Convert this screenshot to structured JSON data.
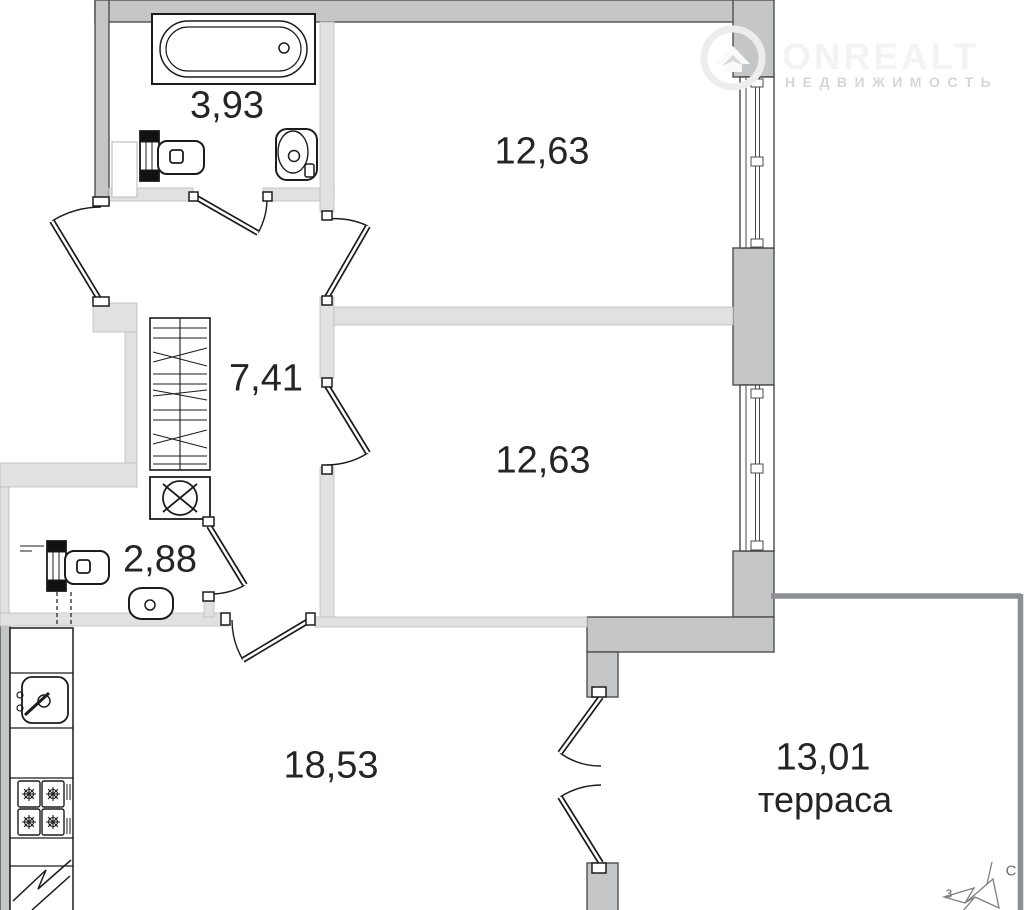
{
  "plan": {
    "rooms": [
      {
        "id": "bathroom",
        "area": "3,93"
      },
      {
        "id": "room-1",
        "area": "12,63"
      },
      {
        "id": "hallway",
        "area": "7,41"
      },
      {
        "id": "room-2",
        "area": "12,63"
      },
      {
        "id": "wc",
        "area": "2,88"
      },
      {
        "id": "kitchen-living",
        "area": "18,53"
      },
      {
        "id": "terrace",
        "area": "13,01",
        "label": "терраса"
      }
    ]
  },
  "watermark": {
    "brand": "ONREALT",
    "subtitle": "НЕДВИЖИМОСТЬ"
  },
  "compass": {
    "north_label": "С",
    "west_label": "з"
  },
  "palette": {
    "exterior_wall": "#c5c6c7",
    "interior_wall": "#e1e1e1",
    "fixture_line": "#1c1c1c",
    "terrace_line": "#8c9094",
    "label_text": "#252525"
  }
}
